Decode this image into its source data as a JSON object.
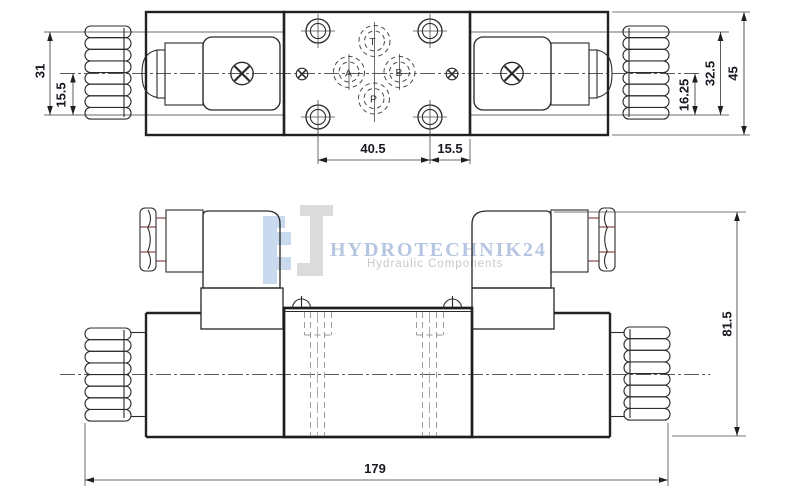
{
  "watermark": {
    "brand": "HYDROTECHNIK24",
    "tagline": "Hydraulic Components"
  },
  "ports": {
    "t": "T",
    "a": "A",
    "b": "B",
    "p": "P"
  },
  "dimensions": {
    "left_cap_height": "31",
    "left_cap_half": "15.5",
    "hole_spacing": "40.5",
    "edge_offset": "15.5",
    "right_cap_half": "16.25",
    "right_cap_height": "32.5",
    "body_height": "45",
    "overall_height": "81.5",
    "overall_length": "179"
  },
  "colors": {
    "line": "#2b2b2b",
    "dim_text": "#181822",
    "hidden_line": "#9a9a9a",
    "connector_accent": "#7a3434",
    "watermark_blue": "#c9d9ee",
    "watermark_gray": "#dbdbdb",
    "brand_text": "#b6c6e1",
    "tagline_text": "#c8c8c8"
  }
}
